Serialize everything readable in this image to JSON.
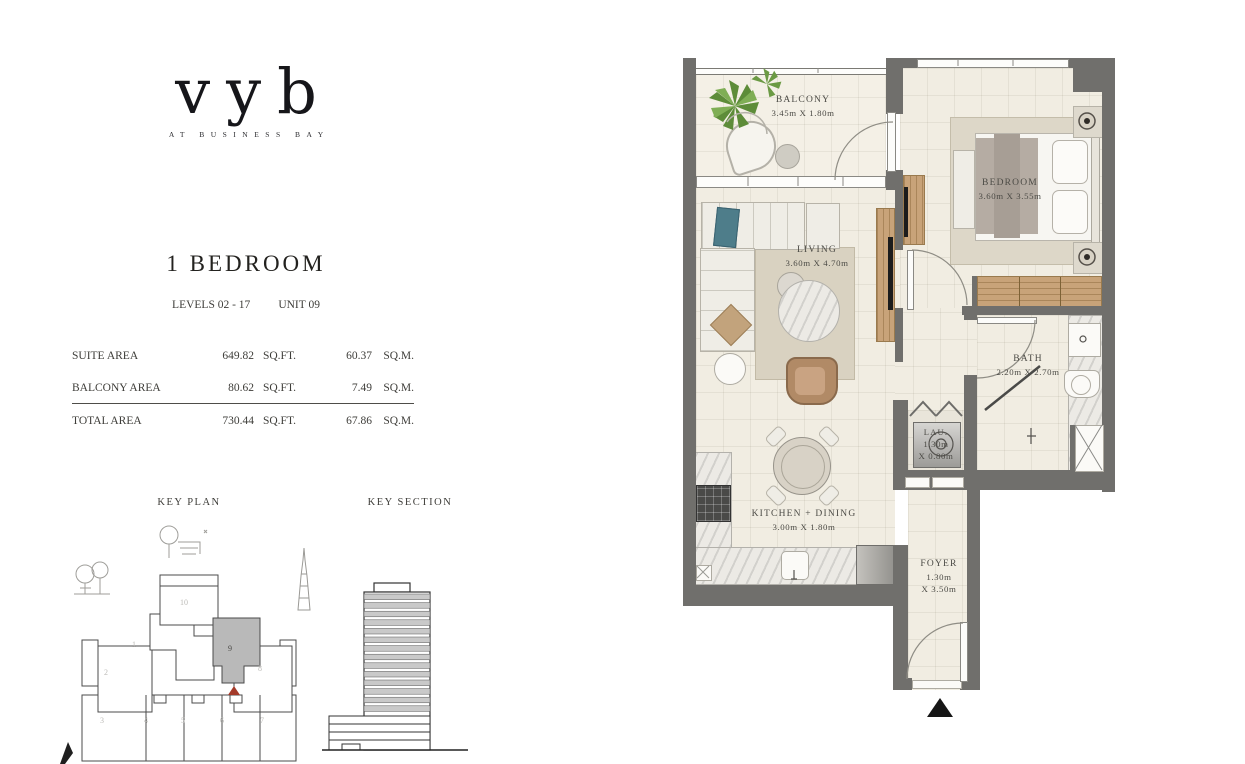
{
  "brand": {
    "logo": "vyb",
    "tagline": "AT BUSINESS BAY"
  },
  "unit": {
    "title": "1 BEDROOM",
    "levels": "LEVELS 02 - 17",
    "unit_no": "UNIT 09"
  },
  "area_table": {
    "rows": [
      {
        "label": "SUITE AREA",
        "sqft": "649.82",
        "sqft_unit": "SQ.FT.",
        "sqm": "60.37",
        "sqm_unit": "SQ.M."
      },
      {
        "label": "BALCONY AREA",
        "sqft": "80.62",
        "sqft_unit": "SQ.FT.",
        "sqm": "7.49",
        "sqm_unit": "SQ.M."
      },
      {
        "label": "TOTAL AREA",
        "sqft": "730.44",
        "sqft_unit": "SQ.FT.",
        "sqm": "67.86",
        "sqm_unit": "SQ.M."
      }
    ]
  },
  "key_plan": {
    "label": "KEY PLAN",
    "highlighted_unit": "9",
    "units": [
      "1",
      "2",
      "3",
      "4",
      "5",
      "6",
      "7",
      "8",
      "9",
      "10"
    ]
  },
  "key_section": {
    "label": "KEY SECTION"
  },
  "floor_plan": {
    "rooms": [
      {
        "name": "BALCONY",
        "dims": "3.45m X 1.80m"
      },
      {
        "name": "BEDROOM",
        "dims": "3.60m X 3.55m"
      },
      {
        "name": "LIVING",
        "dims": "3.60m X 4.70m"
      },
      {
        "name": "BATH",
        "dims": "2.20m X 2.70m"
      },
      {
        "name": "LAU.",
        "dims_l1": "1.30m",
        "dims_l2": "X 0.80m"
      },
      {
        "name": "KITCHEN + DINING",
        "dims": "3.00m X 1.80m"
      },
      {
        "name": "FOYER",
        "dims_l1": "1.30m",
        "dims_l2": "X 3.50m"
      }
    ]
  },
  "colors": {
    "wall": "#706f6c",
    "floor": "#f1ede2",
    "wood": "#c8a379",
    "highlight_unit": "#b9b9b9",
    "marker_red": "#a33a2a",
    "text": "#3e3d39"
  }
}
